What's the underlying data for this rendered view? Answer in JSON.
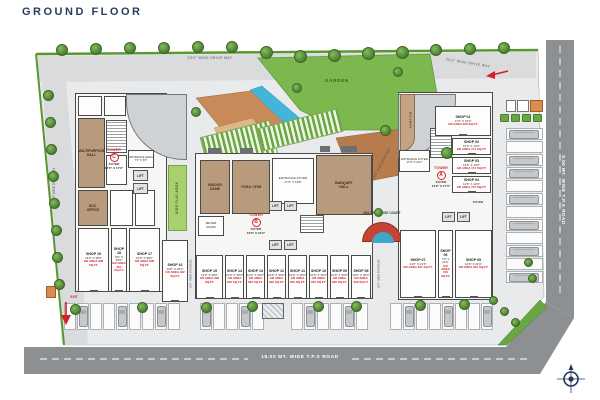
{
  "title": "GROUND FLOOR",
  "roads": {
    "bottom_label": "18.00 MT. WIDE T.P.S ROAD",
    "right_label": "9.00 MT. WIDE T.P.S ROAD",
    "drive_top_left": "20'0\" WIDE DRIVE WAY",
    "drive_top_right": "20'0\" WIDE DRIVE WAY",
    "drive_left": "20'0\" WIDE DRIVE WAY",
    "drive_diagonal": "20'0\" WIDE DRIVE WAY",
    "exit_label": "EXIT"
  },
  "landscape": {
    "garden_label": "GARDEN",
    "kids_play_label": "KIDS PLAY AREA",
    "court_label": "MULTIPURPOSE COURT",
    "ramp_label": "RAMP DN"
  },
  "towers": {
    "a": {
      "tag": "TOWER",
      "letter": "A",
      "foyer": "FOYER\n14'0\" X 17'0\""
    },
    "b": {
      "tag": "TOWER",
      "letter": "B",
      "foyer": "FOYER\n16'0\" X 21'0\""
    },
    "c": {
      "tag": "TOWER",
      "letter": "C",
      "foyer": "FOYER\n16'0\" X 17'0\""
    }
  },
  "rooms": {
    "multipurpose_hall": "MULTIPURPOSE\nHALL",
    "soc_office": "SOC.\nOFFICE",
    "entrance_area_c": "ENTRANCE AREA\n7'0\" X 6'5\"",
    "indoor_game": "INDOOR\nGAME",
    "yoga_gym": "YOGA / GYM",
    "entrance_foyer_b": "ENTRANCE FOYER\n17'3\" X 16'5\"",
    "banquet_hall": "BANQUET\nHALL",
    "meter_room": "METER\nROOM",
    "entrance_foyer_a": "ENTRANCE FOYER\n17'0\" X 24'7\"",
    "foyer_small": "FOYER",
    "lift": "LIFT",
    "passage_left": "10'0\" WIDE PASSAGE",
    "passage_right": "10'0\" WIDE PASSAGE"
  },
  "shops": {
    "left_wing": [
      {
        "name": "SHOP 19",
        "dim": "16'0\" X 38'0\"",
        "area": "GR AREA 608 SQ.FT."
      },
      {
        "name": "SHOP 18",
        "dim": "8'0\" X 38'0\"",
        "area": "GR AREA 304 SQ.FT."
      },
      {
        "name": "SHOP 17",
        "dim": "16'0\" X 38'0\"",
        "area": "GR AREA 608 SQ.FT."
      },
      {
        "name": "SHOP 16",
        "dim": "12'0\" X 36'0\"",
        "area": "GR AREA 432 SQ.FT."
      }
    ],
    "center": [
      {
        "name": "SHOP 15",
        "dim": "13'0\" X 30'0\"",
        "area": "GR AREA 390 SQ.FT."
      },
      {
        "name": "SHOP 14",
        "dim": "10'0\" X 30'0\"",
        "area": "GR AREA 300 SQ.FT."
      },
      {
        "name": "SHOP 13",
        "dim": "10'0\" X 30'0\"",
        "area": "GR AREA 300 SQ.FT."
      },
      {
        "name": "SHOP 12",
        "dim": "10'0\" X 30'0\"",
        "area": "GR AREA 300 SQ.FT."
      },
      {
        "name": "SHOP 11",
        "dim": "10'0\" X 30'0\"",
        "area": "GR AREA 300 SQ.FT."
      },
      {
        "name": "SHOP 10",
        "dim": "10'0\" X 30'0\"",
        "area": "GR AREA 300 SQ.FT."
      },
      {
        "name": "SHOP 09",
        "dim": "10'0\" X 30'0\"",
        "area": "GR AREA 300 SQ.FT."
      },
      {
        "name": "SHOP 08",
        "dim": "10'0\" X 30'0\"",
        "area": "GR AREA 300 SQ.FT."
      }
    ],
    "right_top": [
      {
        "name": "SHOP 01",
        "dim": "17'0\" X 24'0\"",
        "area": "GR AREA 408 SQ.FT."
      },
      {
        "name": "SHOP 02",
        "dim": "14'6\" X 12'0\"",
        "area": "GR AREA 174 SQ.FT."
      },
      {
        "name": "SHOP 03",
        "dim": "14'6\" X 12'0\"",
        "area": "GR AREA 174 SQ.FT."
      },
      {
        "name": "SHOP 04",
        "dim": "14'6\" X 12'0\"",
        "area": "GR AREA 174 SQ.FT."
      }
    ],
    "right_bottom": [
      {
        "name": "SHOP 07",
        "dim": "14'0\" X 21'6\"",
        "area": "GR AREA 301 SQ.FT."
      },
      {
        "name": "SHOP 06",
        "dim": "7'0\" X 21'6\"",
        "area": "GR AREA 150 SQ.FT."
      },
      {
        "name": "SHOP 05",
        "dim": "14'0\" X 21'6\"",
        "area": "GR AREA 301 SQ.FT."
      }
    ]
  },
  "colors": {
    "accent_red": "#cf2128",
    "road_gray": "#8c9093",
    "lawn_green": "#7cb84e",
    "water_blue": "#43b5d9",
    "wall_tan": "#b89b7d",
    "title_navy": "#2a3c5e"
  }
}
